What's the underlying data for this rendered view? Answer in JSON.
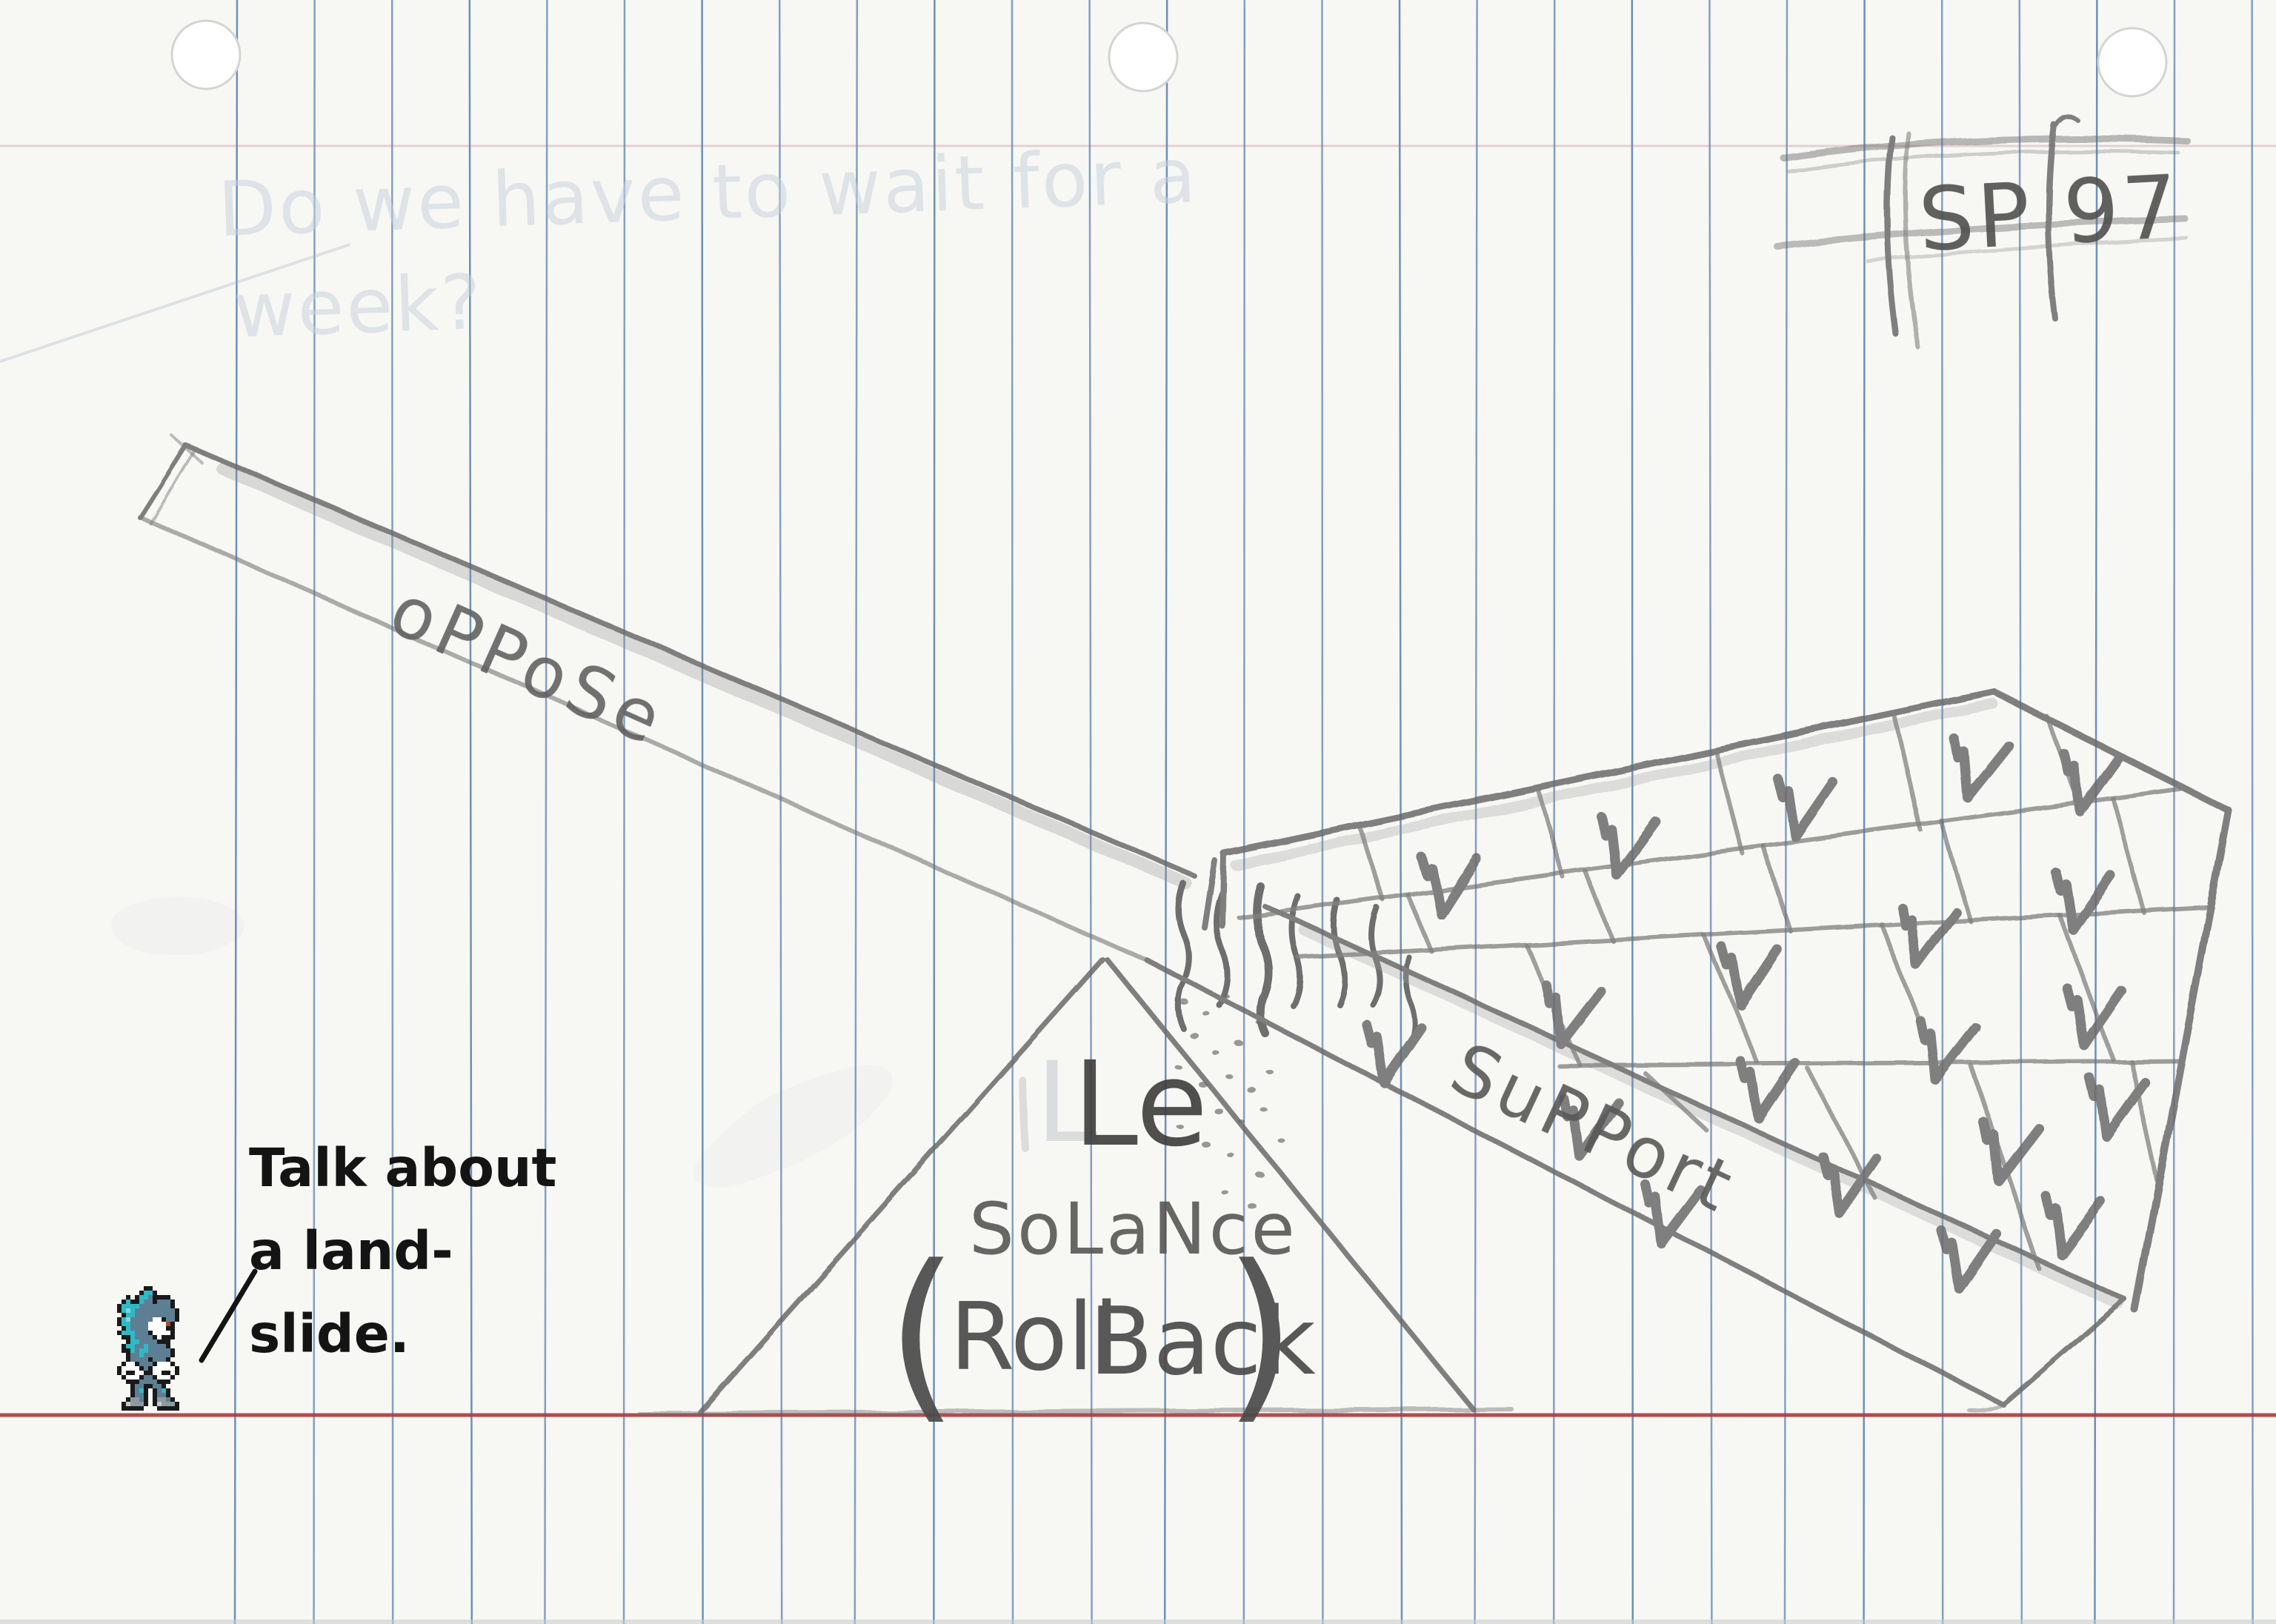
{
  "colors": {
    "paper": "#f7f7f4",
    "ruled_line": "#567fae",
    "margin_line": "#a93b3c",
    "pencil": "#6b6b6b",
    "caption_ink": "#141414",
    "sprite_teal": "#2fb9c6",
    "sprite_slate": "#5e7f93"
  },
  "erased_note": {
    "line1": "Do we have to wait for a",
    "line2": "week?"
  },
  "corner_mark": {
    "label": "SP 97"
  },
  "seesaw": {
    "oppose_label": "oPPoSe",
    "support_label": "SuPPort",
    "fulcrum": {
      "erased_letter": "L",
      "line1": "Le",
      "line2": "SoLaNce",
      "paren_open": "(",
      "word1": "Roll",
      "word2": "Back",
      "paren_close": ")"
    },
    "ballot_checkmark_symbol": "✓",
    "ballot_checkmark_count": 20
  },
  "caption": {
    "line1": "Talk about",
    "line2": "a land-",
    "line3": "slide."
  }
}
